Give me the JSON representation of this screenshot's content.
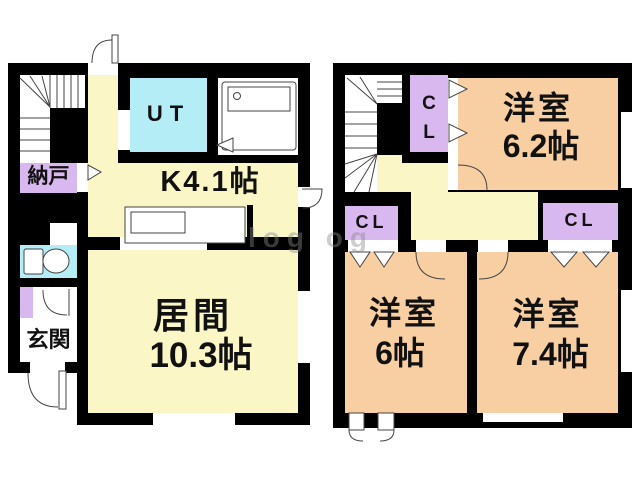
{
  "watermark_text": "log og",
  "colors": {
    "wall": "#000000",
    "room_yellow": "#FAF6C6",
    "room_peach": "#F8CFA2",
    "room_cyan": "#B5EDF7",
    "closet_purple": "#D9B8F0",
    "background": "#FFFFFF"
  },
  "floor1": {
    "storage_label": "納戸",
    "utility_label": "UT",
    "kitchen_label": "K4.1帖",
    "living_name": "居間",
    "living_size": "10.3帖",
    "entrance_label": "玄関"
  },
  "floor2": {
    "closet_top_label": "C\nL",
    "closet_left_label": "CL",
    "closet_right_label": "CL",
    "bedroom1_name": "洋室",
    "bedroom1_size": "6.2帖",
    "bedroom2_name": "洋室",
    "bedroom2_size": "6帖",
    "bedroom3_name": "洋室",
    "bedroom3_size": "7.4帖"
  }
}
